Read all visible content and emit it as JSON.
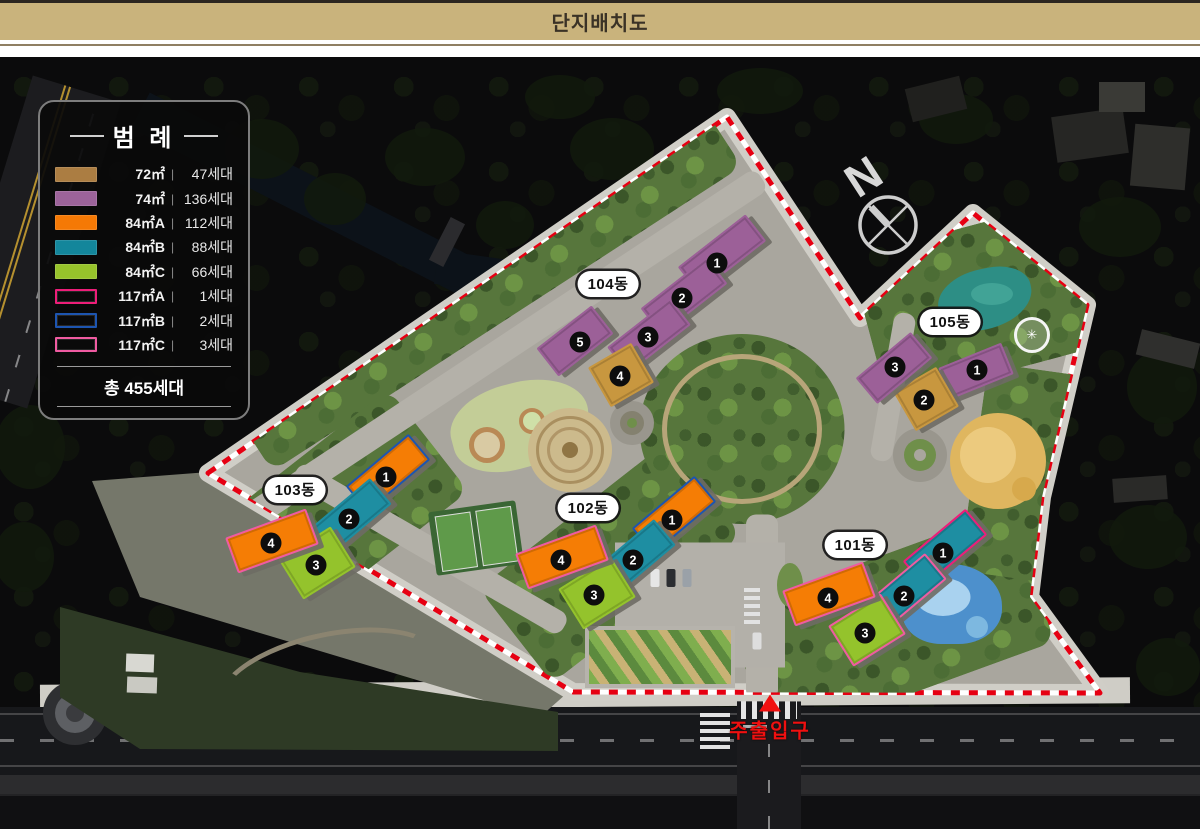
{
  "header": {
    "title": "단지배치도"
  },
  "legend": {
    "title": "범 례",
    "separator": "|",
    "items": [
      {
        "label": "72㎡",
        "count": "47세대",
        "color": "#ab7d42",
        "swatch": "fill"
      },
      {
        "label": "74㎡",
        "count": "136세대",
        "color": "#9c639a",
        "swatch": "fill"
      },
      {
        "label": "84㎡A",
        "count": "112세대",
        "color": "#f57905",
        "swatch": "fill"
      },
      {
        "label": "84㎡B",
        "count": "88세대",
        "color": "#13869b",
        "swatch": "fill"
      },
      {
        "label": "84㎡C",
        "count": "66세대",
        "color": "#97c32b",
        "swatch": "fill"
      },
      {
        "label": "117㎡A",
        "count": "1세대",
        "color": "#ed1e79",
        "swatch": "outline"
      },
      {
        "label": "117㎡B",
        "count": "2세대",
        "color": "#1d55b0",
        "swatch": "outline"
      },
      {
        "label": "117㎡C",
        "count": "3세대",
        "color": "#ef5ba1",
        "swatch": "outline"
      }
    ],
    "total": "총 455세대"
  },
  "map": {
    "north_label": "N",
    "fountain_icon": "✳",
    "entrance": {
      "label": "주출입구"
    },
    "buildings": [
      {
        "name": "101동",
        "units": [
          {
            "no": "1",
            "color": "#1e8ea2",
            "outline": "#ed1e79"
          },
          {
            "no": "2",
            "color": "#1e8ea2",
            "outline": "#ef5ba1"
          },
          {
            "no": "3",
            "color": "#94c32c",
            "outline": "#ef5ba1"
          },
          {
            "no": "4",
            "color": "#f57d05",
            "outline": "#ef5ba1"
          }
        ]
      },
      {
        "name": "102동",
        "units": [
          {
            "no": "1",
            "color": "#f57d05",
            "outline": "#1d55b0"
          },
          {
            "no": "2",
            "color": "#1e8ea2"
          },
          {
            "no": "3",
            "color": "#94c32c"
          },
          {
            "no": "4",
            "color": "#f57d05",
            "outline": "#ef5ba1"
          }
        ]
      },
      {
        "name": "103동",
        "units": [
          {
            "no": "1",
            "color": "#f57d05",
            "outline": "#1d55b0"
          },
          {
            "no": "2",
            "color": "#1e8ea2"
          },
          {
            "no": "3",
            "color": "#94c32c"
          },
          {
            "no": "4",
            "color": "#f57d05",
            "outline": "#ef5ba1"
          }
        ]
      },
      {
        "name": "104동",
        "units": [
          {
            "no": "1",
            "color": "#9c6098"
          },
          {
            "no": "2",
            "color": "#9c6098"
          },
          {
            "no": "3",
            "color": "#9c6098"
          },
          {
            "no": "4",
            "color": "#c8973f"
          },
          {
            "no": "5",
            "color": "#9c6098"
          }
        ]
      },
      {
        "name": "105동",
        "units": [
          {
            "no": "1",
            "color": "#9c6098"
          },
          {
            "no": "2",
            "color": "#c8973f"
          },
          {
            "no": "3",
            "color": "#9c6098"
          }
        ]
      }
    ]
  }
}
